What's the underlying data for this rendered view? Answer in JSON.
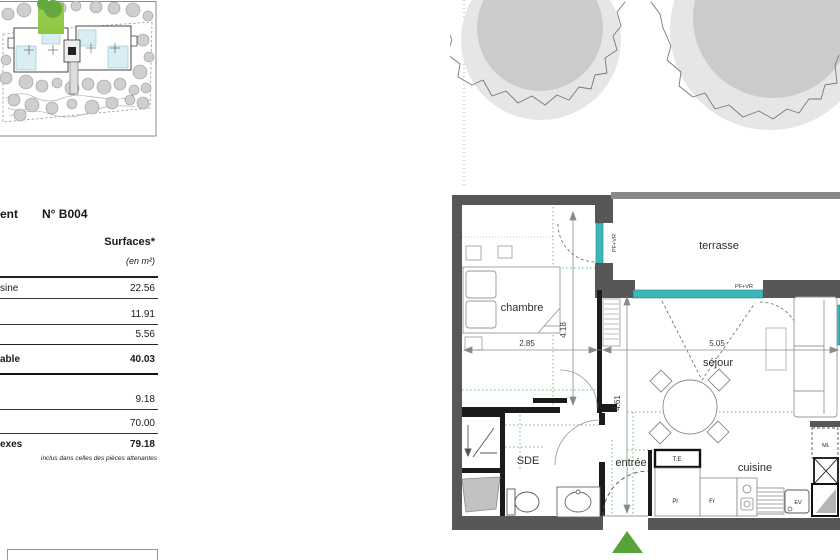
{
  "document_type": "floor-plan sheet",
  "colors": {
    "wall_dark": "#575757",
    "wall_black": "#1b1b1b",
    "window_teal": "#3ab7b7",
    "entrance_green": "#57a339",
    "site_unit_green": "#8ec63f",
    "ceiling_line_green": "#6abf6a",
    "tree_outer": "#e6e6e6",
    "tree_inner": "#cbcbcb"
  },
  "table": {
    "title_fragment": "ent",
    "unit_number": "N° B004",
    "col_header": "Surfaces*",
    "col_subheader": "(en m²)",
    "rows": [
      {
        "label": "sine",
        "value": "22.56"
      },
      {
        "label": "",
        "value": "11.91"
      },
      {
        "label": "",
        "value": "5.56"
      },
      {
        "label": "able",
        "value": "40.03"
      },
      {
        "label": "",
        "value": "9.18"
      },
      {
        "label": "",
        "value": "70.00"
      },
      {
        "label": "exes",
        "value": "79.18"
      }
    ],
    "footnote": "inclus dans celles des pièces attenantes"
  },
  "plan": {
    "room_labels": {
      "terrasse": "terrasse",
      "chambre": "chambre",
      "sejour": "séjour",
      "sde": "SDE",
      "entree": "entrée",
      "cuisine": "cuisine"
    },
    "dimensions": {
      "chambre_width": "2.85",
      "chambre_depth": "4.18",
      "sejour_width": "5.05",
      "sejour_depth": "4.61"
    },
    "window_label": "PF+VR",
    "equipment_labels": {
      "te": "T.E",
      "pl": "Pl",
      "fr": "Fr",
      "ev": "EV",
      "ml": "ML"
    }
  }
}
